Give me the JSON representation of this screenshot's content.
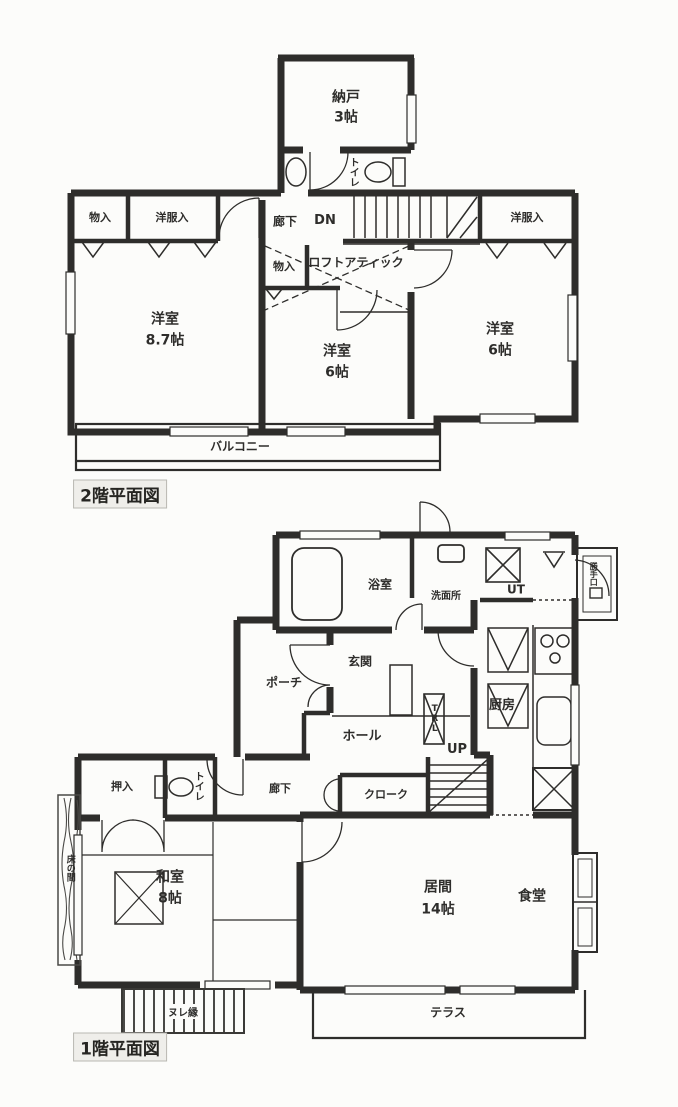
{
  "page": {
    "background": "#fcfcfa",
    "ink": "#2e2d2b",
    "type_note": "scanned Japanese floor plan, two storeys"
  },
  "floor2": {
    "title": "2階平面図",
    "labels": {
      "nando": "納戸",
      "nando_size": "3帖",
      "toilet": "トイレ",
      "corridor": "廊下",
      "dn": "DN",
      "storage_tl": "物入",
      "closet_tl": "洋服入",
      "closet_tr": "洋服入",
      "storage_mid": "物入",
      "loft": "ロフトアティック",
      "room_w": "洋室",
      "room_w_size": "8.7帖",
      "room_c": "洋室",
      "room_c_size": "6帖",
      "room_e": "洋室",
      "room_e_size": "6帖",
      "balcony": "バルコニー"
    }
  },
  "floor1": {
    "title": "1階平面図",
    "labels": {
      "bath": "浴室",
      "washroom": "洗面所",
      "ut": "UT",
      "backdoor": "勝手口",
      "kitchen": "厨房",
      "entrance": "玄関",
      "porch": "ポーチ",
      "hall": "ホール",
      "trl": "TRL",
      "up": "UP",
      "cloak": "クローク",
      "corridor": "廊下",
      "toilet": "トイレ",
      "oshiire": "押入",
      "washitsu": "和室",
      "washitsu_size": "8帖",
      "living": "居間",
      "living_size": "14帖",
      "dining": "食堂",
      "terrace": "テラス",
      "nureen": "ヌレ縁",
      "tokonoma": "床の間"
    }
  }
}
